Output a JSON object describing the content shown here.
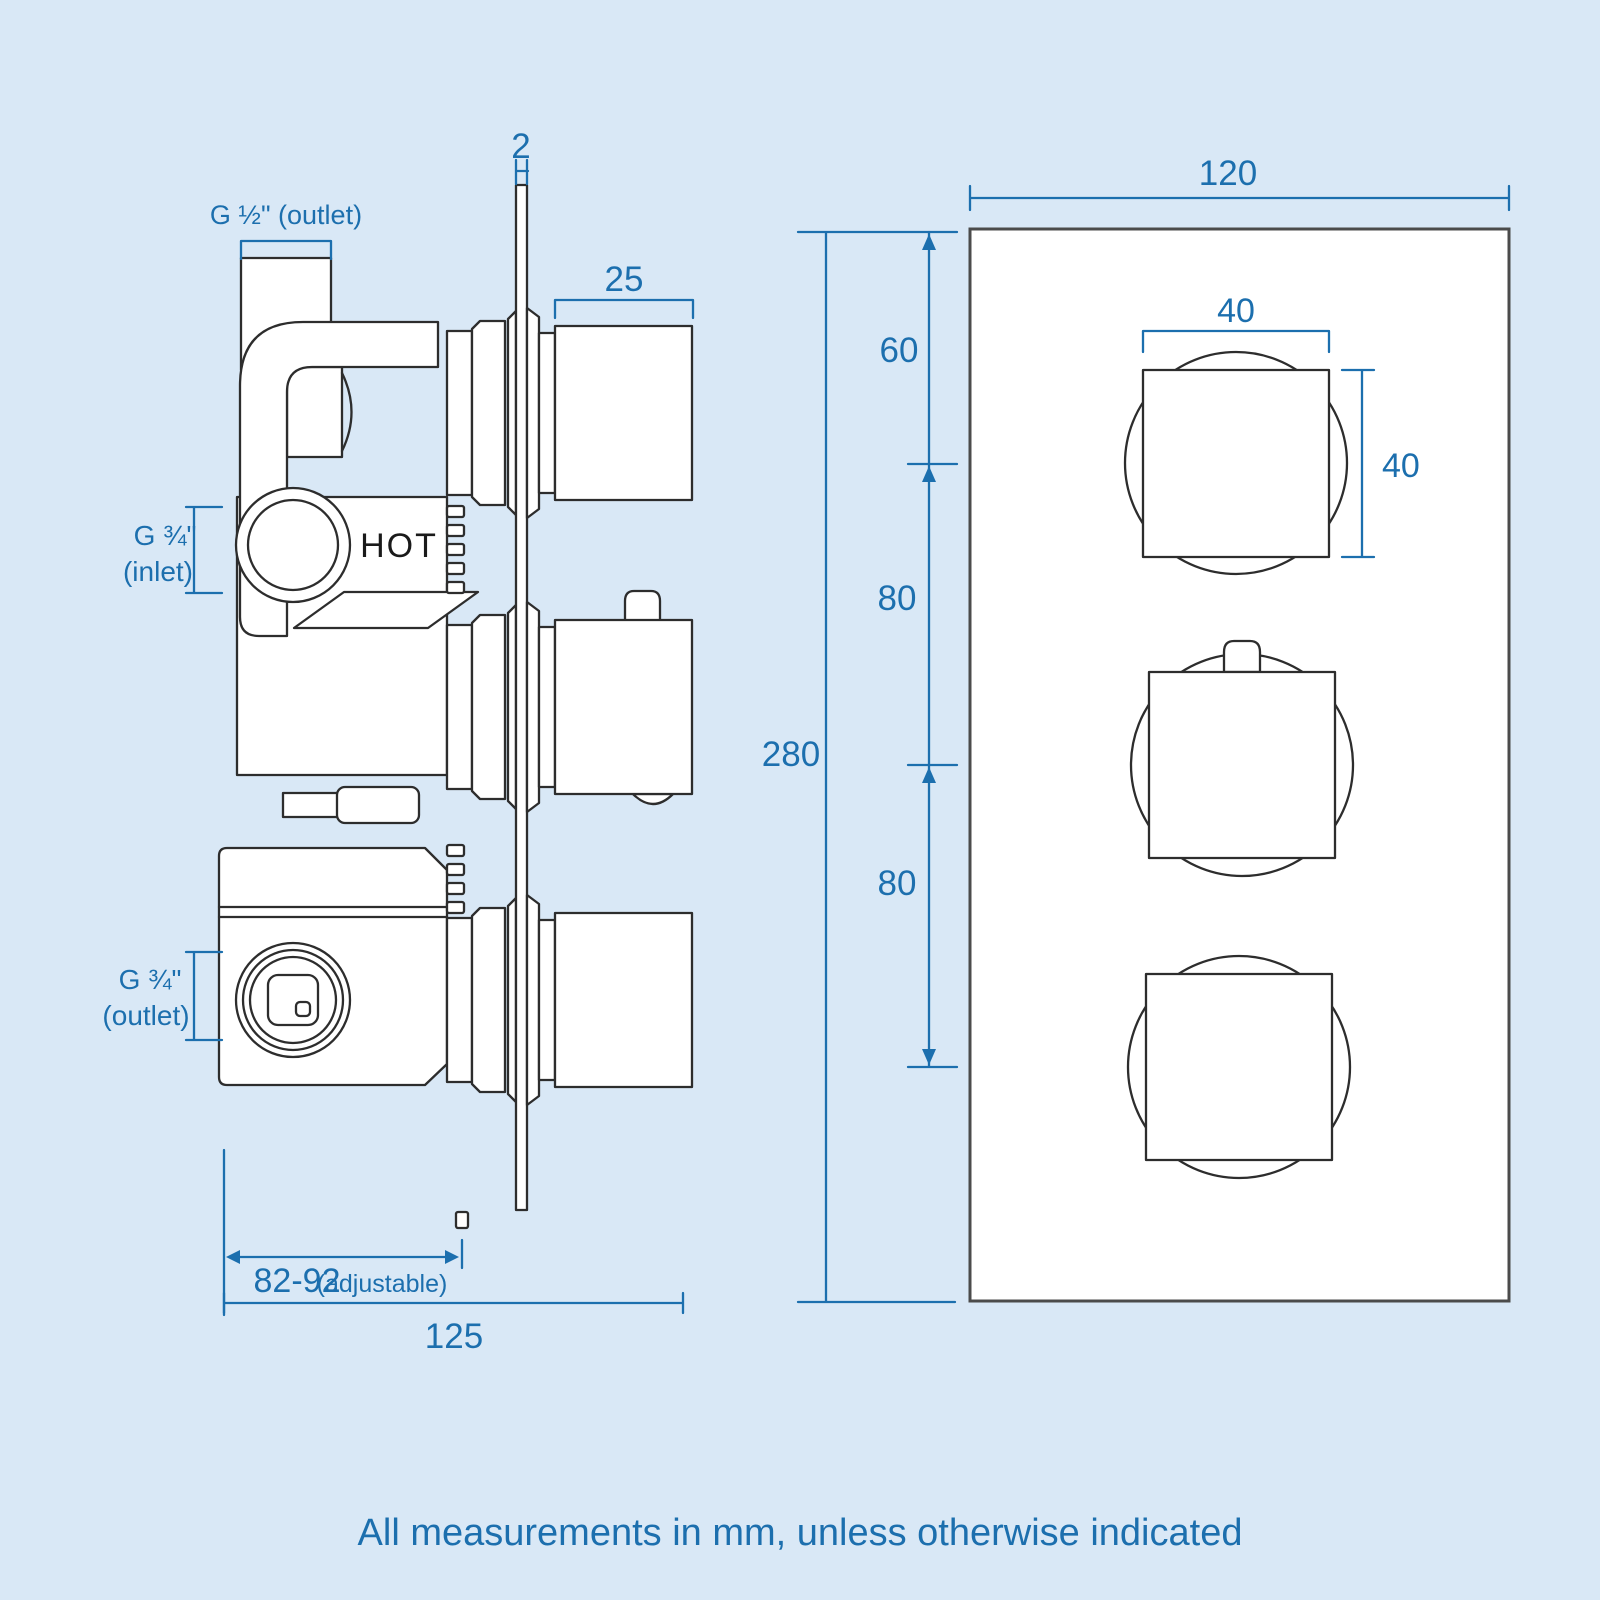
{
  "colors": {
    "bg": "#d9e8f6",
    "accent": "#1c6fae",
    "line": "#2d2d2d",
    "plate": "#4b4b4b",
    "fill": "#ffffff"
  },
  "left_view": {
    "hot_label": "HOT",
    "dims": {
      "plate_thickness": "2",
      "outlet_half": "G ½\" (outlet)",
      "knob_depth": "25",
      "inlet_size": "G ¾\"",
      "inlet_note": "(inlet)",
      "outlet_size": "G ¾\"",
      "outlet_note": "(outlet)",
      "depth_adjustable": "82-92",
      "depth_adjustable_note": "(adjustable)",
      "depth_total": "125"
    }
  },
  "right_view": {
    "dims": {
      "plate_width": "120",
      "plate_height": "280",
      "top_offset": "60",
      "knob_spacing_1": "80",
      "knob_spacing_2": "80",
      "knob_width": "40",
      "knob_height": "40"
    }
  },
  "footer": {
    "note": "All measurements in mm, unless otherwise indicated"
  }
}
